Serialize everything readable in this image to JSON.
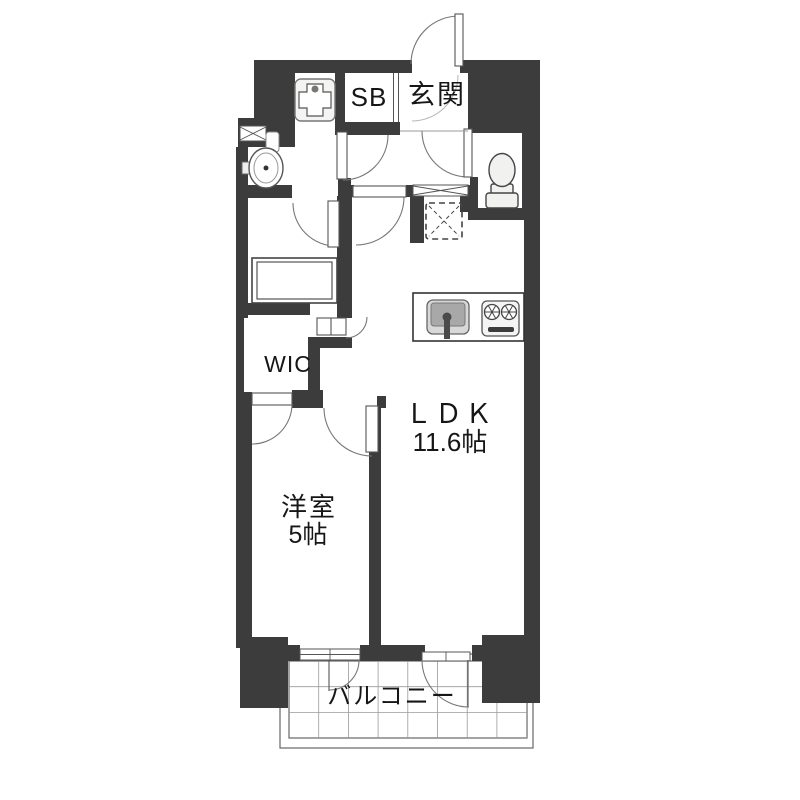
{
  "plan": {
    "type": "apartment-floor-plan",
    "colors": {
      "wall": "#3c3c3c",
      "line": "#555555",
      "arc": "#777777",
      "text": "#161616",
      "fixture_fill": "#f1f1ef",
      "sink_outer": "#d8d8d8",
      "sink_basin": "#a8a8a8",
      "tile_grid": "#9a9a9a",
      "background": "#ffffff"
    },
    "rooms": {
      "genkan": {
        "label": "玄関"
      },
      "shoe_box": {
        "label": "SB"
      },
      "wic": {
        "label": "WIC"
      },
      "ldk": {
        "label": "ＬＤＫ",
        "size": "11.6帖"
      },
      "western_room": {
        "label": "洋室",
        "size": "5帖"
      },
      "balcony": {
        "label": "バルコニー"
      }
    },
    "fixtures": [
      "entrance-swing-door",
      "washing-machine-pan",
      "washbasin",
      "bathtub",
      "toilet",
      "small-window",
      "transom-window",
      "refrigerator-space",
      "kitchen-sink",
      "two-burner-stove",
      "sliding-glass-windows",
      "balcony-tiles"
    ]
  }
}
